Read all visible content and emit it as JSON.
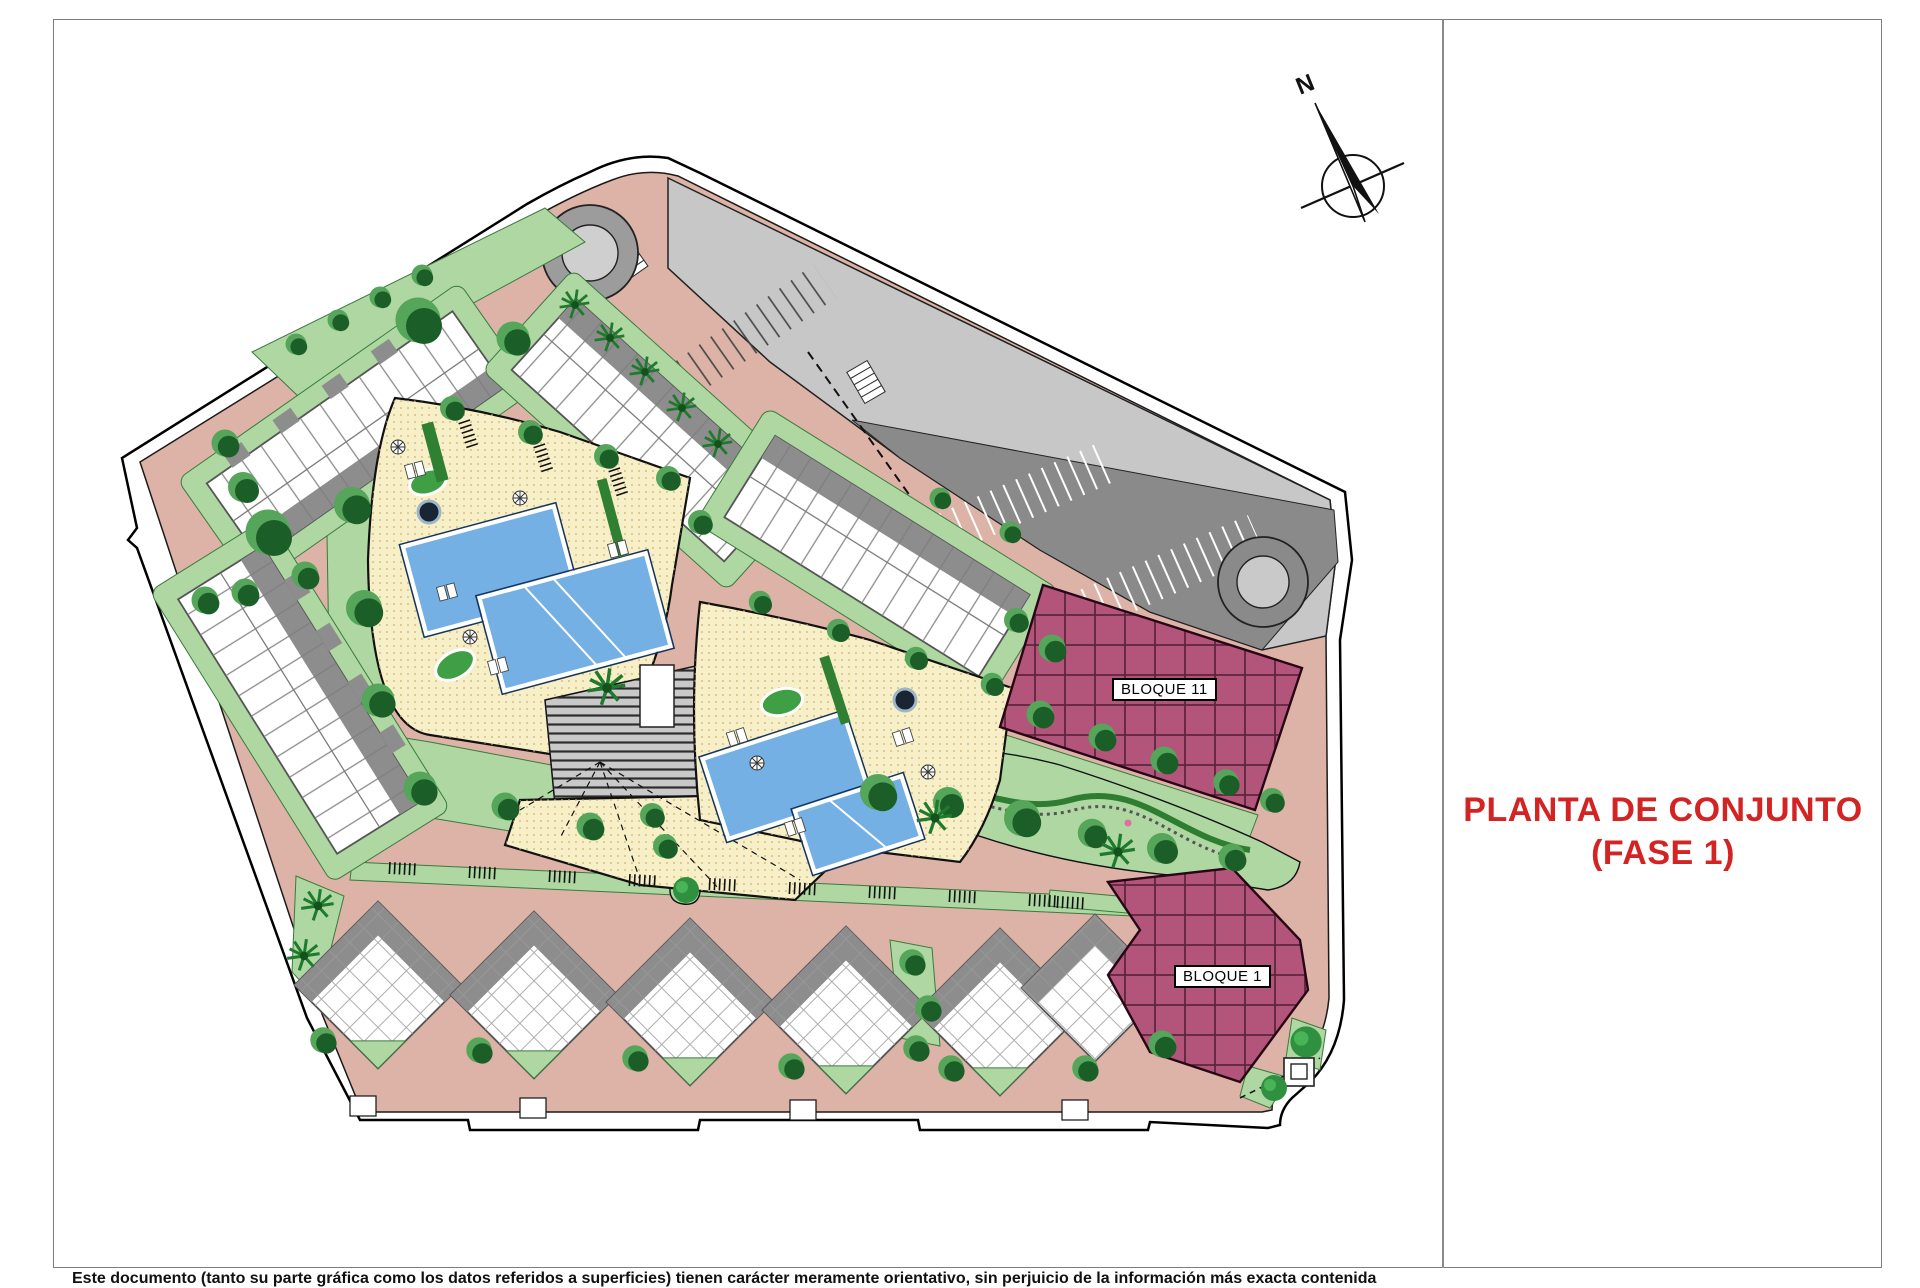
{
  "page": {
    "title_line1": "PLANTA DE CONJUNTO",
    "title_line2": "(FASE 1)",
    "disclaimer": "Este documento (tanto su parte gráfica como los datos referidos a superficies) tienen carácter meramente orientativo, sin perjuicio de la información más exacta contenida"
  },
  "plan": {
    "compass_label": "N",
    "labels": {
      "bloque11": "BLOQUE 11",
      "bloque1": "BLOQUE 1"
    },
    "palette": {
      "accent_red": "#d42323",
      "road_pink": "#dcb3a6",
      "lawn_green": "#aed7a2",
      "tree_dark_green": "#1b5e28",
      "tree_light_green": "#55a65a",
      "pool_deck_yellow": "#f7efc8",
      "pool_blue": "#74b0e4",
      "parking_light_gray": "#c7c7c7",
      "parking_dark_gray": "#8a8a8a",
      "building_roof_gray": "#8d8d8d",
      "bloque_mauve": "#b3547b",
      "boundary_black": "#000000"
    }
  }
}
